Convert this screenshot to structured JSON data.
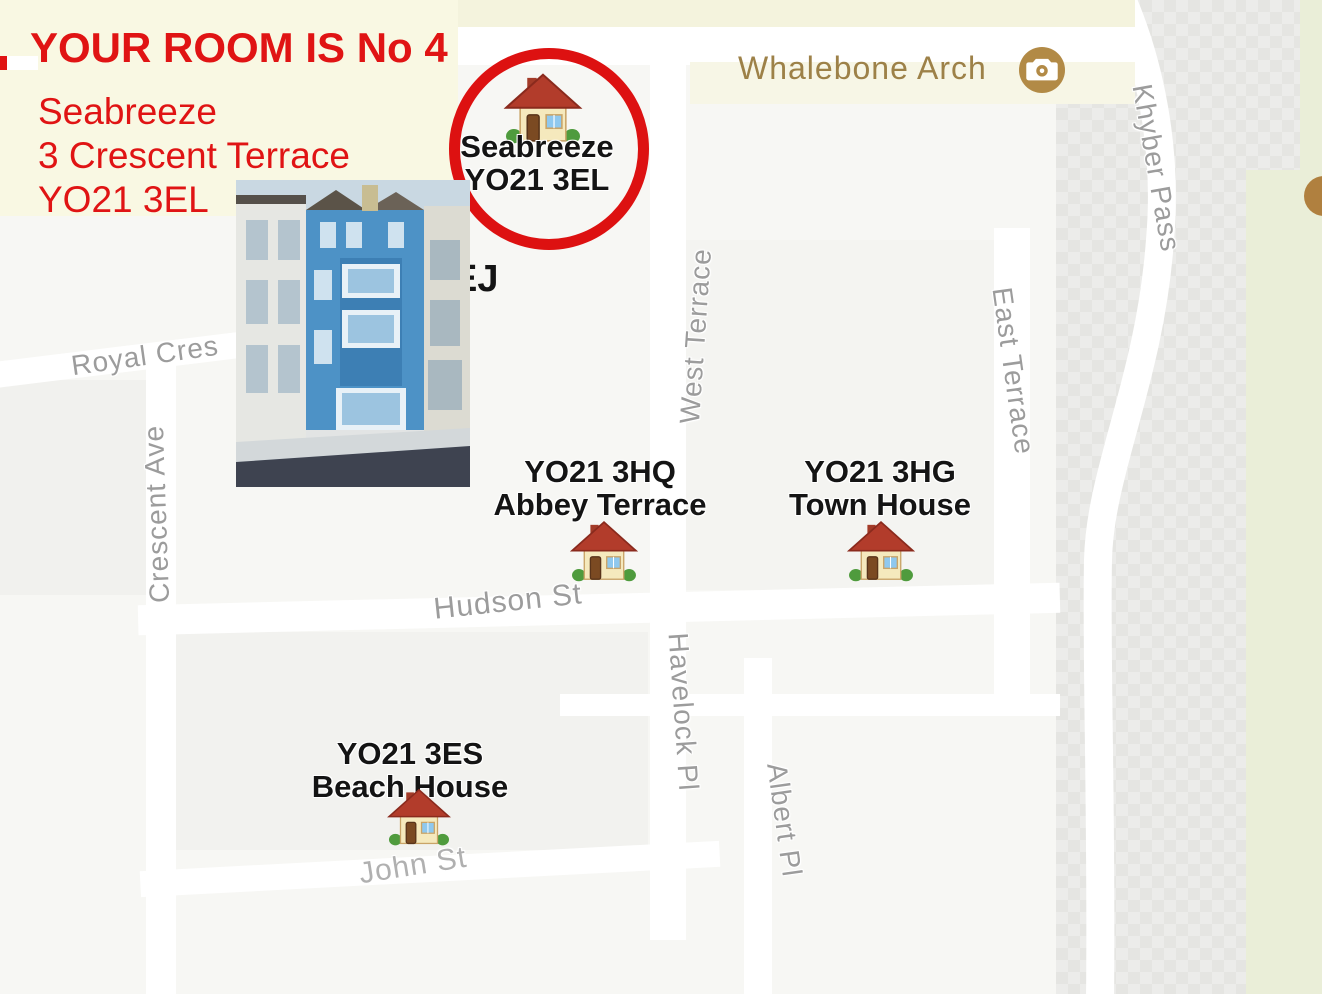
{
  "colors": {
    "annotation_red": "#e01414",
    "street_label_gray": "#9c9c9c",
    "poi_brown": "#9d8148",
    "map_green_strip": "#eaeed8",
    "cream_overlay": "#f9f8e3"
  },
  "header": {
    "room_line": "YOUR ROOM IS No 4",
    "address": [
      "Seabreeze",
      "3 Crescent Terrace",
      "YO21 3EL"
    ]
  },
  "highlight": {
    "name": "Seabreeze",
    "postcode": "YO21 3EL"
  },
  "partial_label": "EJ",
  "poi": {
    "whalebone_arch": "Whalebone Arch"
  },
  "streets": {
    "royal_cres": "Royal Cres",
    "crescent_ave": "Crescent Ave",
    "west_terrace": "West Terrace",
    "east_terrace": "East Terrace",
    "khyber_pass": "Khyber Pass",
    "hudson_st": "Hudson St",
    "havelock_pl": "Havelock Pl",
    "albert_pl": "Albert Pl",
    "john_st": "John St"
  },
  "properties": [
    {
      "postcode": "YO21 3HQ",
      "name": "Abbey Terrace"
    },
    {
      "postcode": "YO21 3HG",
      "name": "Town House"
    },
    {
      "postcode": "YO21 3ES",
      "name": "Beach House"
    }
  ]
}
